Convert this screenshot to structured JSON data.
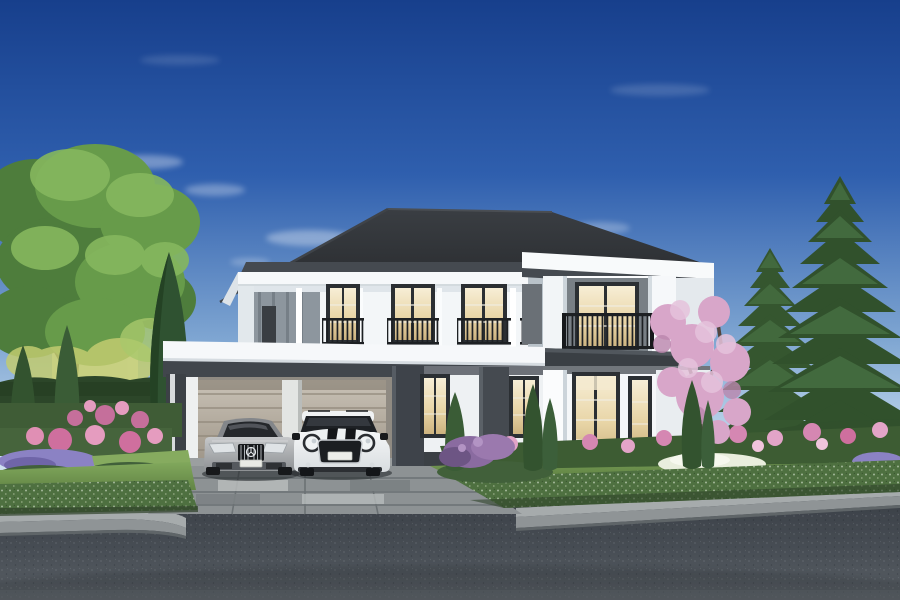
{
  "scene": {
    "description": "Daytime photorealistic exterior rendering of a two-story white luxury house with charcoal hip roof, flat-roof double carport with a silver sedan and a white compact SUV, juliet balconies with iron railings, landscaped garden with pink, purple and white flowers, tall Norfolk pines on the right, a large deciduous tree on the left, concrete paver driveway, gray curb and dark asphalt road in the foreground."
  },
  "palette": {
    "sky_top": "#173f8c",
    "sky_mid": "#3c6bb4",
    "sky_horizon": "#dfeaf3",
    "cloud": "#ffffff",
    "roof_dark": "#2b2e32",
    "soffit_dark": "#454a50",
    "cornice_white": "#f6f8fa",
    "wall_white": "#f3f6f8",
    "wall_bright": "#fbfcfd",
    "wall_shaded": "#dde3e8",
    "panel_gray": "#8d969e",
    "frame_dark": "#2b2f33",
    "glass_warm": "#ecdcb0",
    "railing_iron": "#1d2023",
    "band_dark": "#3a3f44",
    "column_dark": "#3e434a",
    "garage_door": "#b9b1a5",
    "garage_divider": "#e3e5e3",
    "car_silver": "#a7a9ac",
    "car_white": "#eef0f1",
    "car_glass": "#1e2125",
    "plate_white": "#e9eae5",
    "lawn_green": "#6f9150",
    "lawn_light": "#86ab5f",
    "hedge_dark": "#41603a",
    "hedge_fence": "#2c4629",
    "hedge_front": "#4e7040",
    "bush_base": "#3d5c33",
    "flower_pink": "#d587b2",
    "flower_rose": "#cf6f9e",
    "flower_purple": "#8b82c4",
    "flower_white": "#e9eedd",
    "blossom_pink": "#d8a6c9",
    "tree_green": "#679b4a",
    "tree_green_dark": "#4e7d3c",
    "tree_yellow": "#c2cc70",
    "pine_green": "#35562f",
    "cypress_green": "#33532f",
    "trunk_brown": "#5a4a3c",
    "branch_dark": "#4a3f35",
    "driveway_gray": "#8d9294",
    "paver_light": "#b7bbbb",
    "paver_dark": "#7c8284",
    "walkway_gray": "#9aa0a3",
    "curb_gray": "#a6abac",
    "curb_face": "#8f9496",
    "road_asphalt": "#474d54",
    "neighbor_wall": "#e8e9e6",
    "step_gray": "#7c8287"
  },
  "objects": {
    "house": {
      "name": "two-story-house",
      "stories": 2,
      "roof": "hip",
      "upper_windows": 3,
      "balconies": "iron-juliet",
      "entrance": "double-french-doors"
    },
    "carport": {
      "name": "attached-carport",
      "bays": 2,
      "door": "sectional-garage-door"
    },
    "cars": [
      {
        "name": "silver-sedan",
        "color_key": "car_silver",
        "grille": "vertical-slats-with-star"
      },
      {
        "name": "white-suv",
        "color_key": "car_white",
        "hood_stripes": 2,
        "headlights": "round"
      }
    ],
    "vegetation": [
      "deciduous-tree-left",
      "columnar-cypresses",
      "norfolk-pines-right",
      "pink-blossom-tree",
      "boxwood-hedges",
      "flower-beds"
    ],
    "ground": [
      "lawn",
      "paver-driveway",
      "entry-steps",
      "concrete-curb",
      "asphalt-road"
    ]
  }
}
